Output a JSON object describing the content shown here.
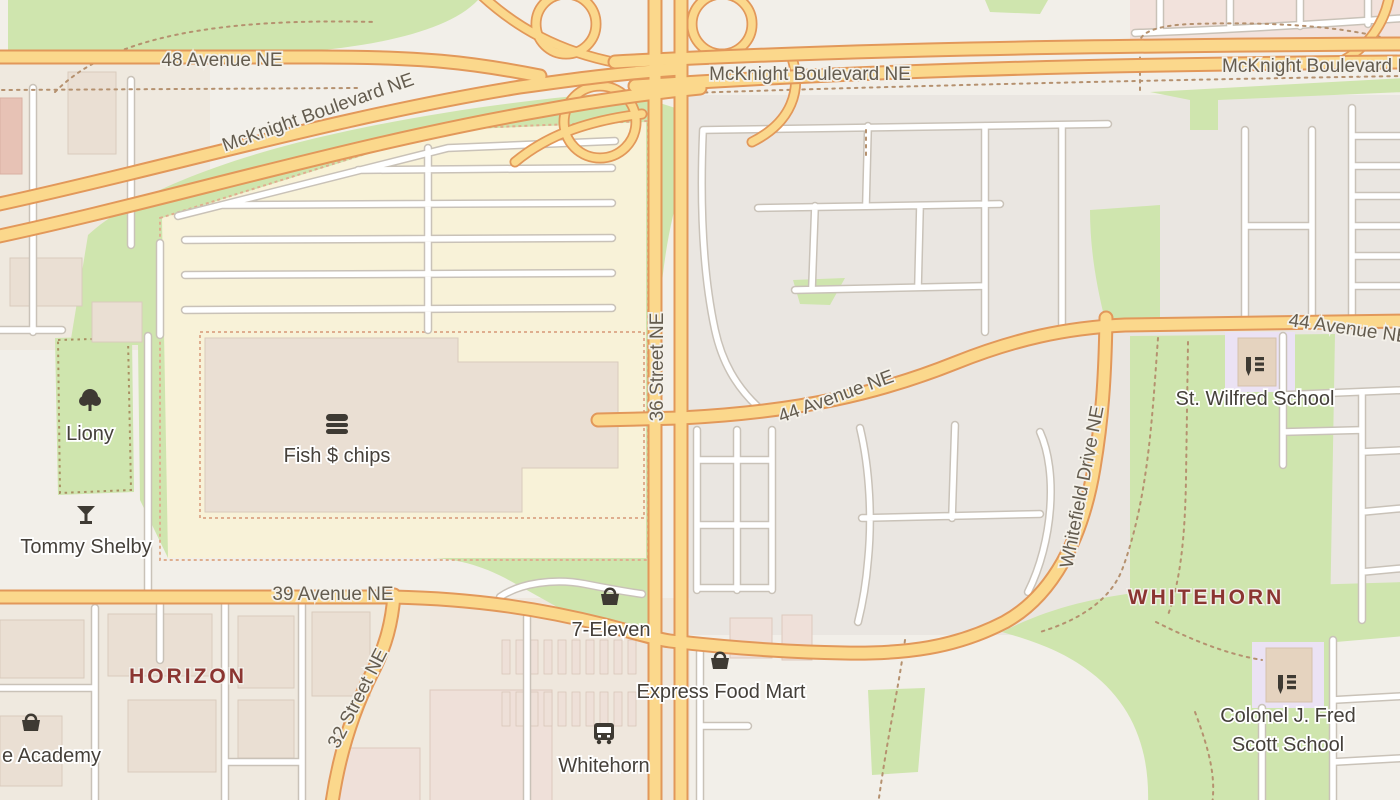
{
  "map_type": "street-map",
  "district_labels": {
    "horizon": "HORIZON",
    "whitehorn": "WHITEHORN"
  },
  "streets": {
    "ave48": "48 Avenue NE",
    "mcknight": "McKnight Boulevard NE",
    "st36": "36 Street NE",
    "ave44": "44 Avenue NE",
    "whitefield": "Whitefield Drive NE",
    "ave39": "39 Avenue NE",
    "st32": "32 Street NE"
  },
  "pois": {
    "liony": {
      "label": "Liony",
      "icon": "tree"
    },
    "tommy_shelby": {
      "label": "Tommy Shelby",
      "icon": "cocktail-glass"
    },
    "fish_chips": {
      "label": "Fish $ chips",
      "icon": "fast-food"
    },
    "seven_eleven": {
      "label": "7-Eleven",
      "icon": "shopping-basket"
    },
    "express_food_mart": {
      "label": "Express Food Mart",
      "icon": "shopping-basket"
    },
    "whitehorn_station": {
      "label": "Whitehorn",
      "icon": "bus"
    },
    "st_wilfred": {
      "label": "St. Wilfred School",
      "icon": "school"
    },
    "colonel_scott": {
      "label_line1": "Colonel J. Fred",
      "label_line2": "Scott School",
      "icon": "school"
    },
    "academy": {
      "label": "e Academy",
      "icon": "shopping-basket"
    }
  },
  "colors": {
    "land": "#f2efe9",
    "residential": "#eae6e1",
    "industrial": "#efe9df",
    "retail_zone": "#f8f2d8",
    "green_area": "#cfe5ae",
    "school_area": "#ebe2f4",
    "building": "#eadfd3",
    "pink_zone": "#f2e2dc",
    "primary_road_fill": "#fbd88c",
    "primary_road_casing": "#e2985a",
    "minor_road_fill": "#ffffff",
    "minor_road_casing": "#c9c2b8",
    "footpath_dashed": "#b5916f",
    "district_label": "#8b3531",
    "street_label": "#645c4f",
    "poi_label": "#45403a",
    "poi_icon": "#3e3a33"
  }
}
